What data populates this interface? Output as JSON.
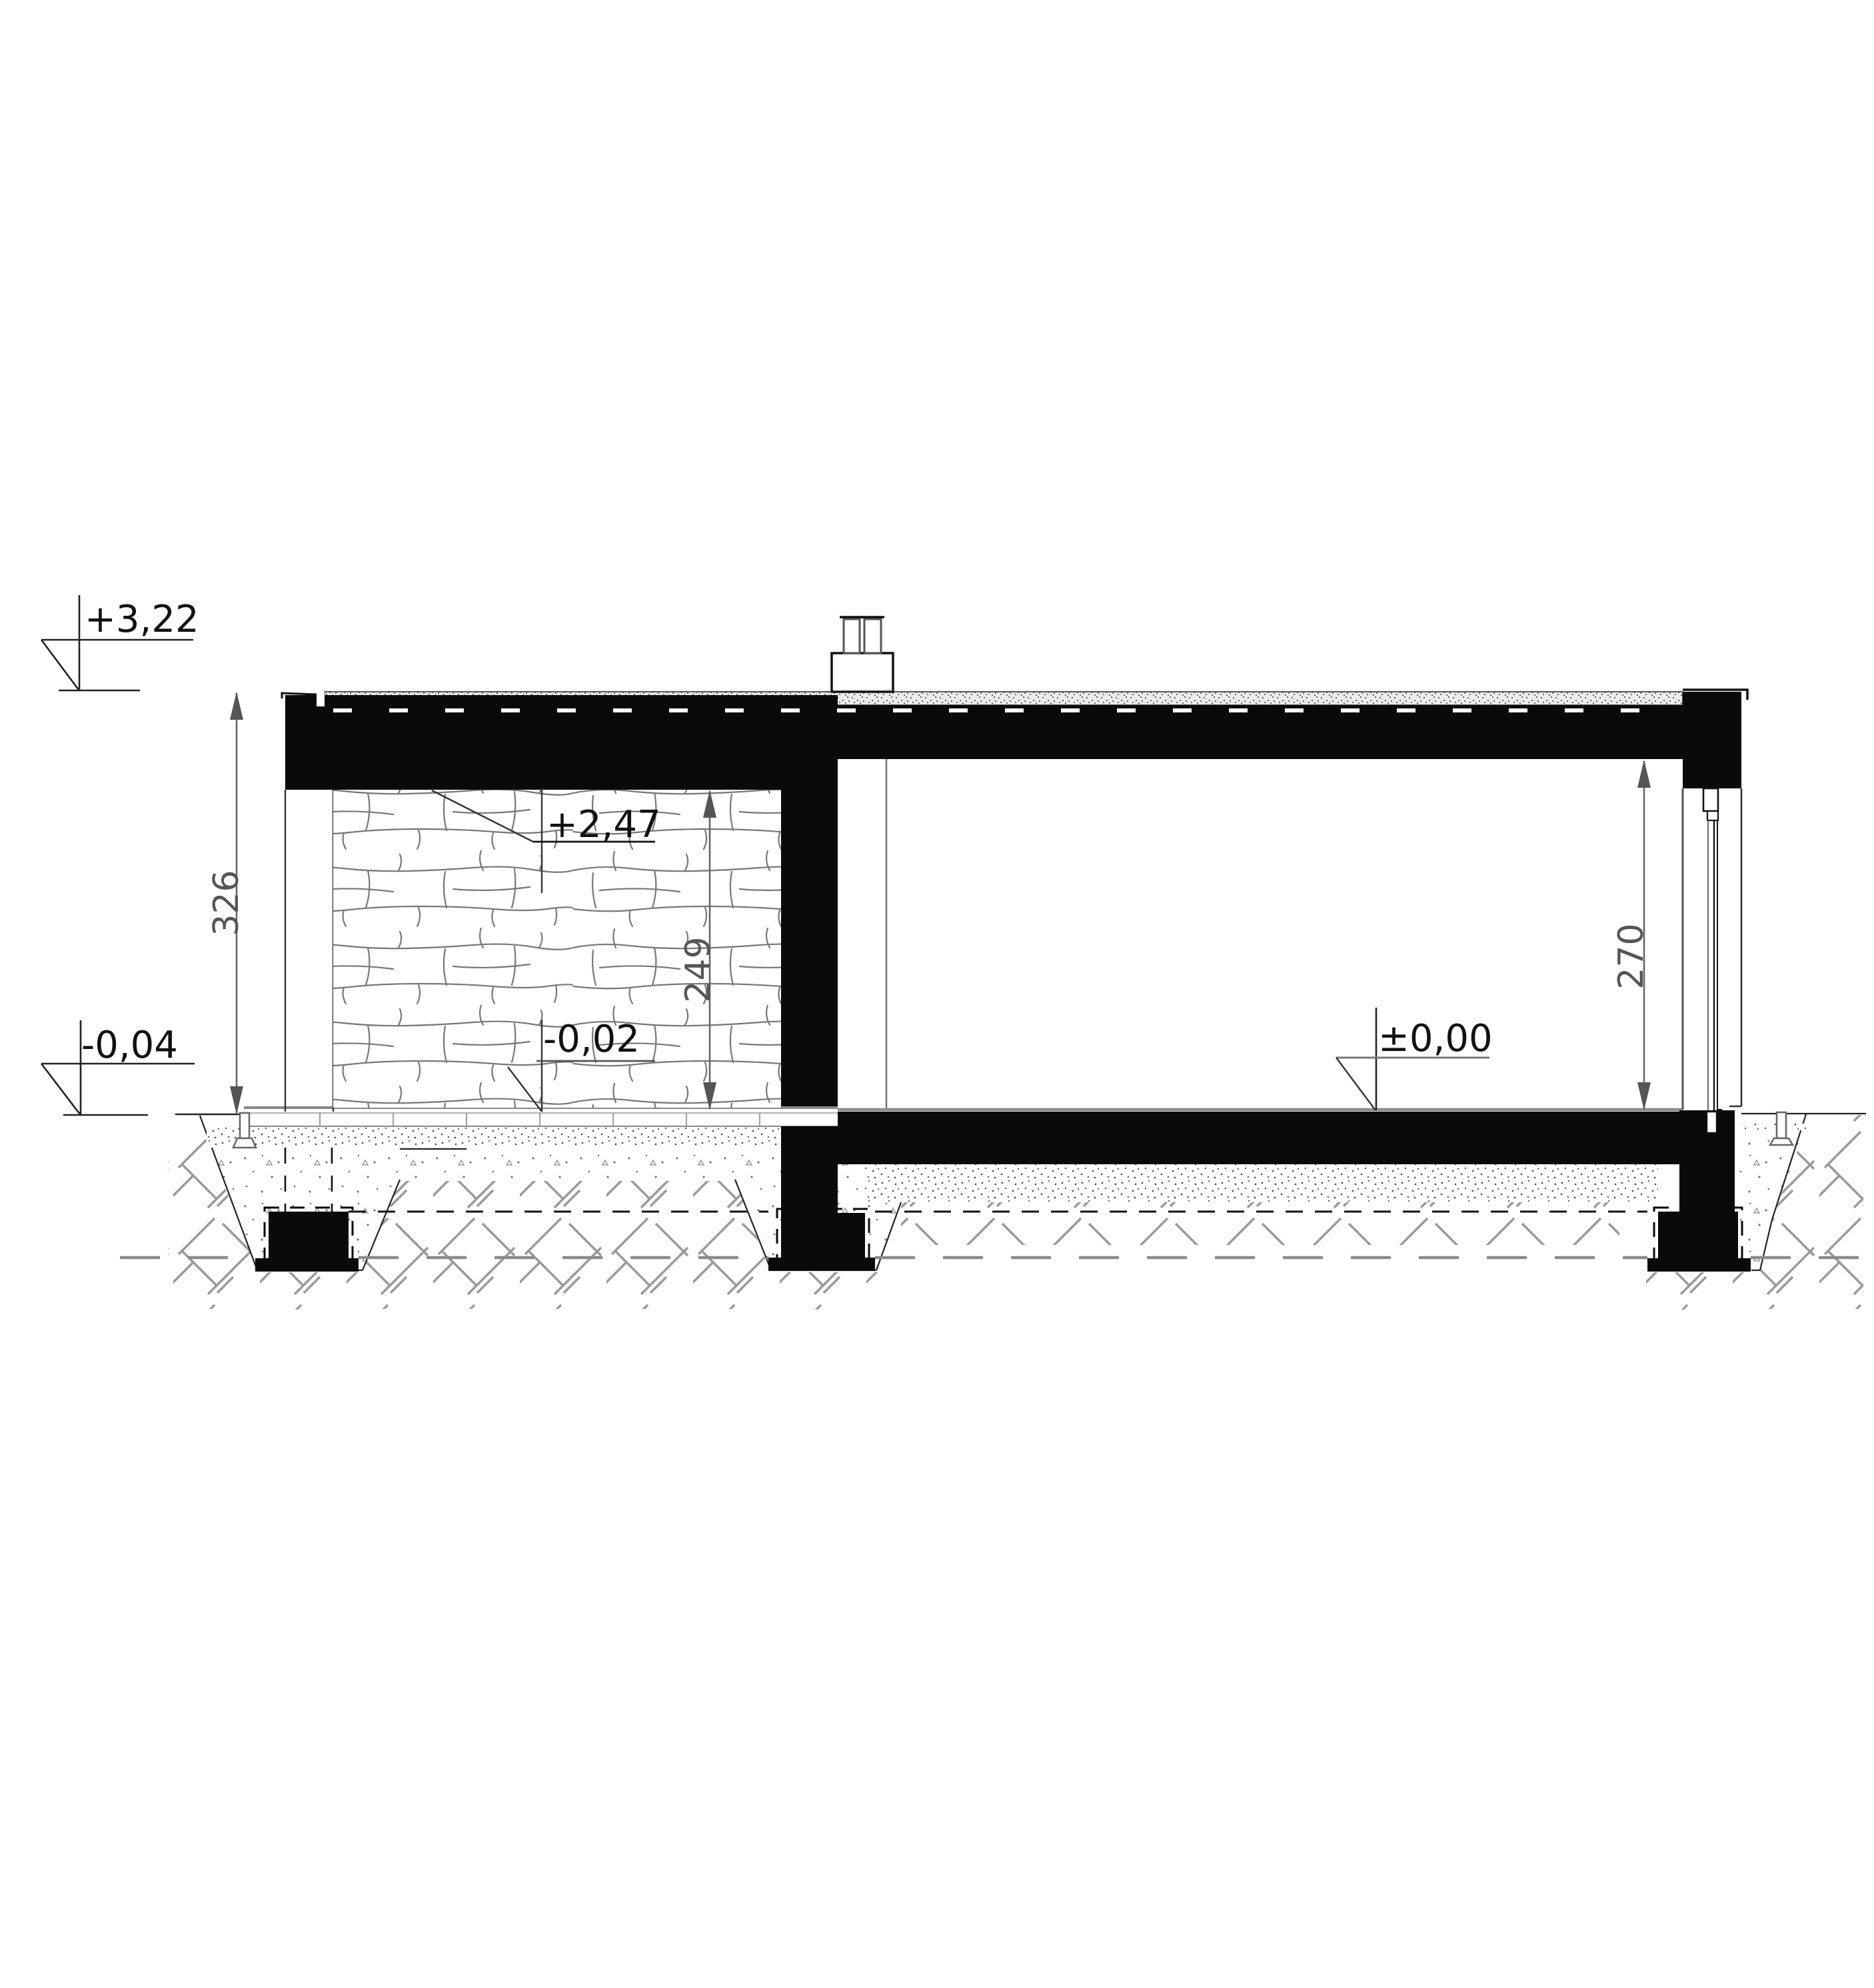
{
  "drawing": {
    "type": "architectural-section",
    "levels": {
      "roof_top": "+3,22",
      "grade_left": "-0,04",
      "porch_ceiling": "+2,47",
      "terrace": "-0,02",
      "floor": "±0,00"
    },
    "dimensions": {
      "total_height": "326",
      "porch_clear_height": "249",
      "room_clear_height": "270"
    },
    "colors": {
      "ink": "#0a0a0a",
      "dim_gray": "#555555",
      "hatch_gray": "#999999"
    }
  }
}
